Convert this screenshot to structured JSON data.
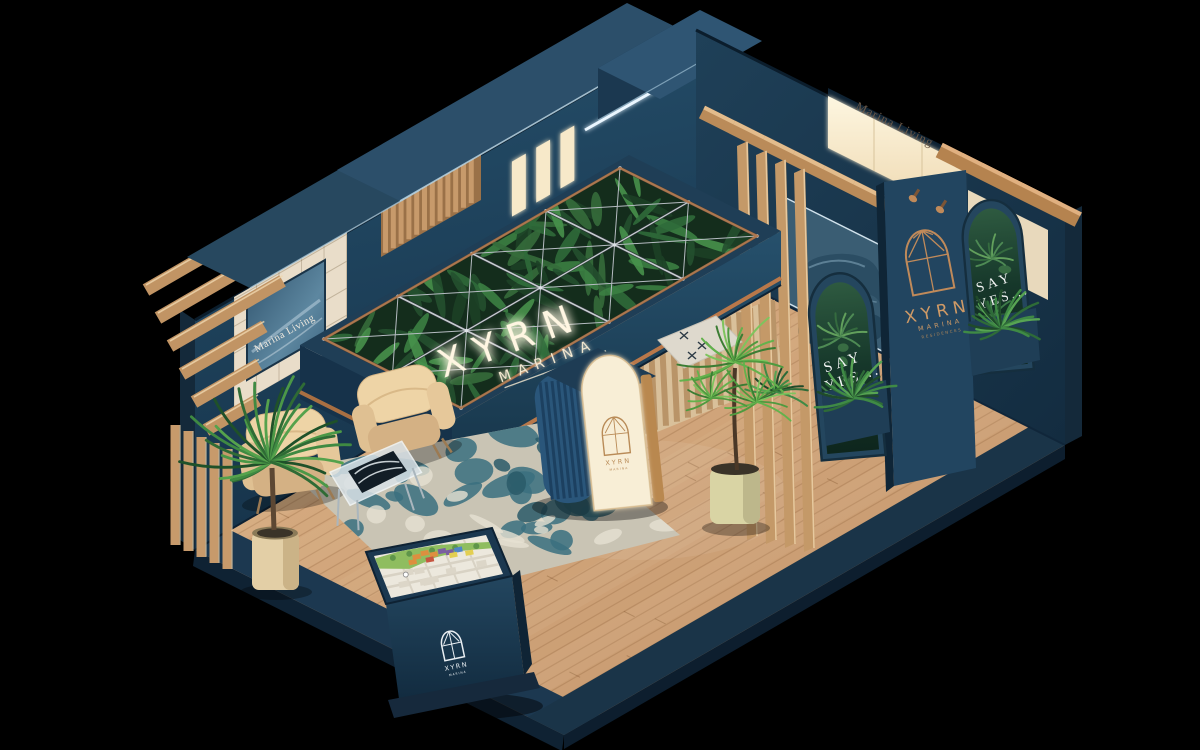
{
  "scene": {
    "subject": "XYRN Marina exhibition booth (isometric 3D render)",
    "background": "#000000"
  },
  "canopy_sign": {
    "line1": "XYRN",
    "line2": "MARINA"
  },
  "exterior_sign": {
    "text": "Marina Living"
  },
  "wall_screen": {
    "text": "Marina Living"
  },
  "pillar_sign": {
    "line1": "XYRN",
    "line2": "MARINA",
    "line3": "RESIDENCES"
  },
  "banner_left": {
    "line1": "SAY",
    "line2": "YES..."
  },
  "banner_right": {
    "line1": "SAY",
    "line2": "YES..."
  },
  "reception_desk": {
    "logo_text": "XYRN",
    "logo_sub": "MARINA"
  },
  "kiosk": {
    "logo_text": "XYRN",
    "logo_sub": "MARINA"
  },
  "palette": {
    "navy": "#1d3a52",
    "navy_deep": "#14293c",
    "wood": "#c0895a",
    "wood_light": "#ddb287",
    "floor": "#d3a87c",
    "cream": "#f3e7cc",
    "copper": "#b9784a",
    "gold": "#c08a5a",
    "green_deep": "#16331f",
    "green_leaf": "#3f7a45",
    "leather_champagne": "#e6c79b",
    "sofa_blue": "#2b4d63",
    "rug_teal": "#39707f",
    "glow_white": "#fff6e2",
    "map_green": "#8fbd60",
    "map_orange": "#dd8f3f",
    "map_purple": "#7a5fa0",
    "map_blue": "#4f86c6",
    "map_yellow": "#e3cf52"
  }
}
